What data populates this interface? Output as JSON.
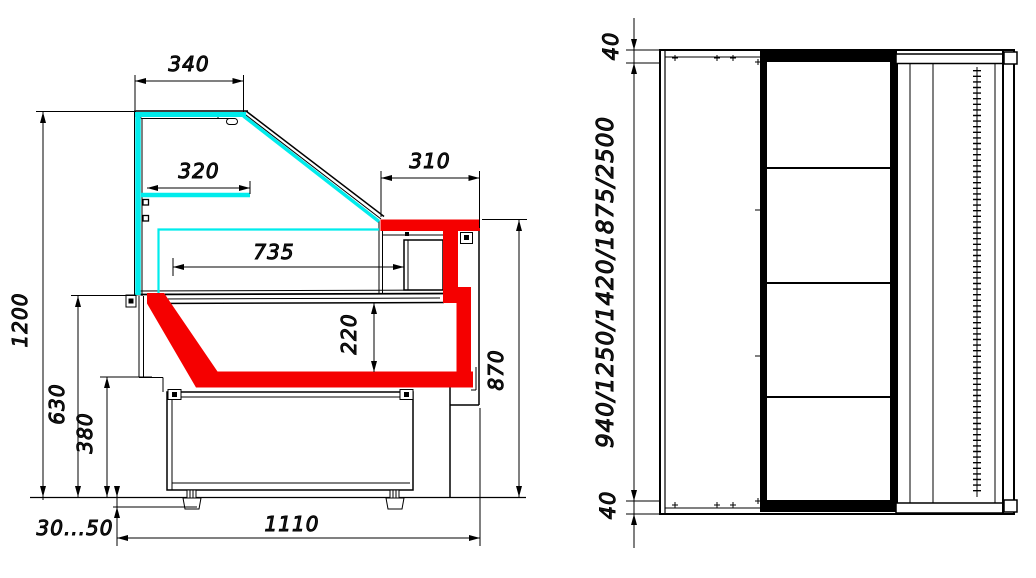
{
  "drawing": {
    "type": "technical-drawing",
    "description": "Refrigerated display counter: side cross-section (left) and plan view (right)",
    "colors": {
      "glass": "#00ecec",
      "profile": "#f50000",
      "line": "#000000",
      "text": "#1c1c1c",
      "background": "#ffffff"
    },
    "side_view": {
      "name": "side-section-view",
      "dims": {
        "canopy_width": "340",
        "shelf_width": "320",
        "counter_width": "310",
        "display_depth": "735",
        "overall_height": "1200",
        "deck_height": "630",
        "base_height": "380",
        "well_depth": "220",
        "counter_height": "870",
        "leg_adjust_range": "30...50",
        "overall_depth": "1110"
      }
    },
    "top_view": {
      "name": "plan-view",
      "dims": {
        "end_panel_top": "40",
        "case_lengths": "940/1250/1420/1875/2500",
        "end_panel_bottom": "40"
      }
    }
  }
}
